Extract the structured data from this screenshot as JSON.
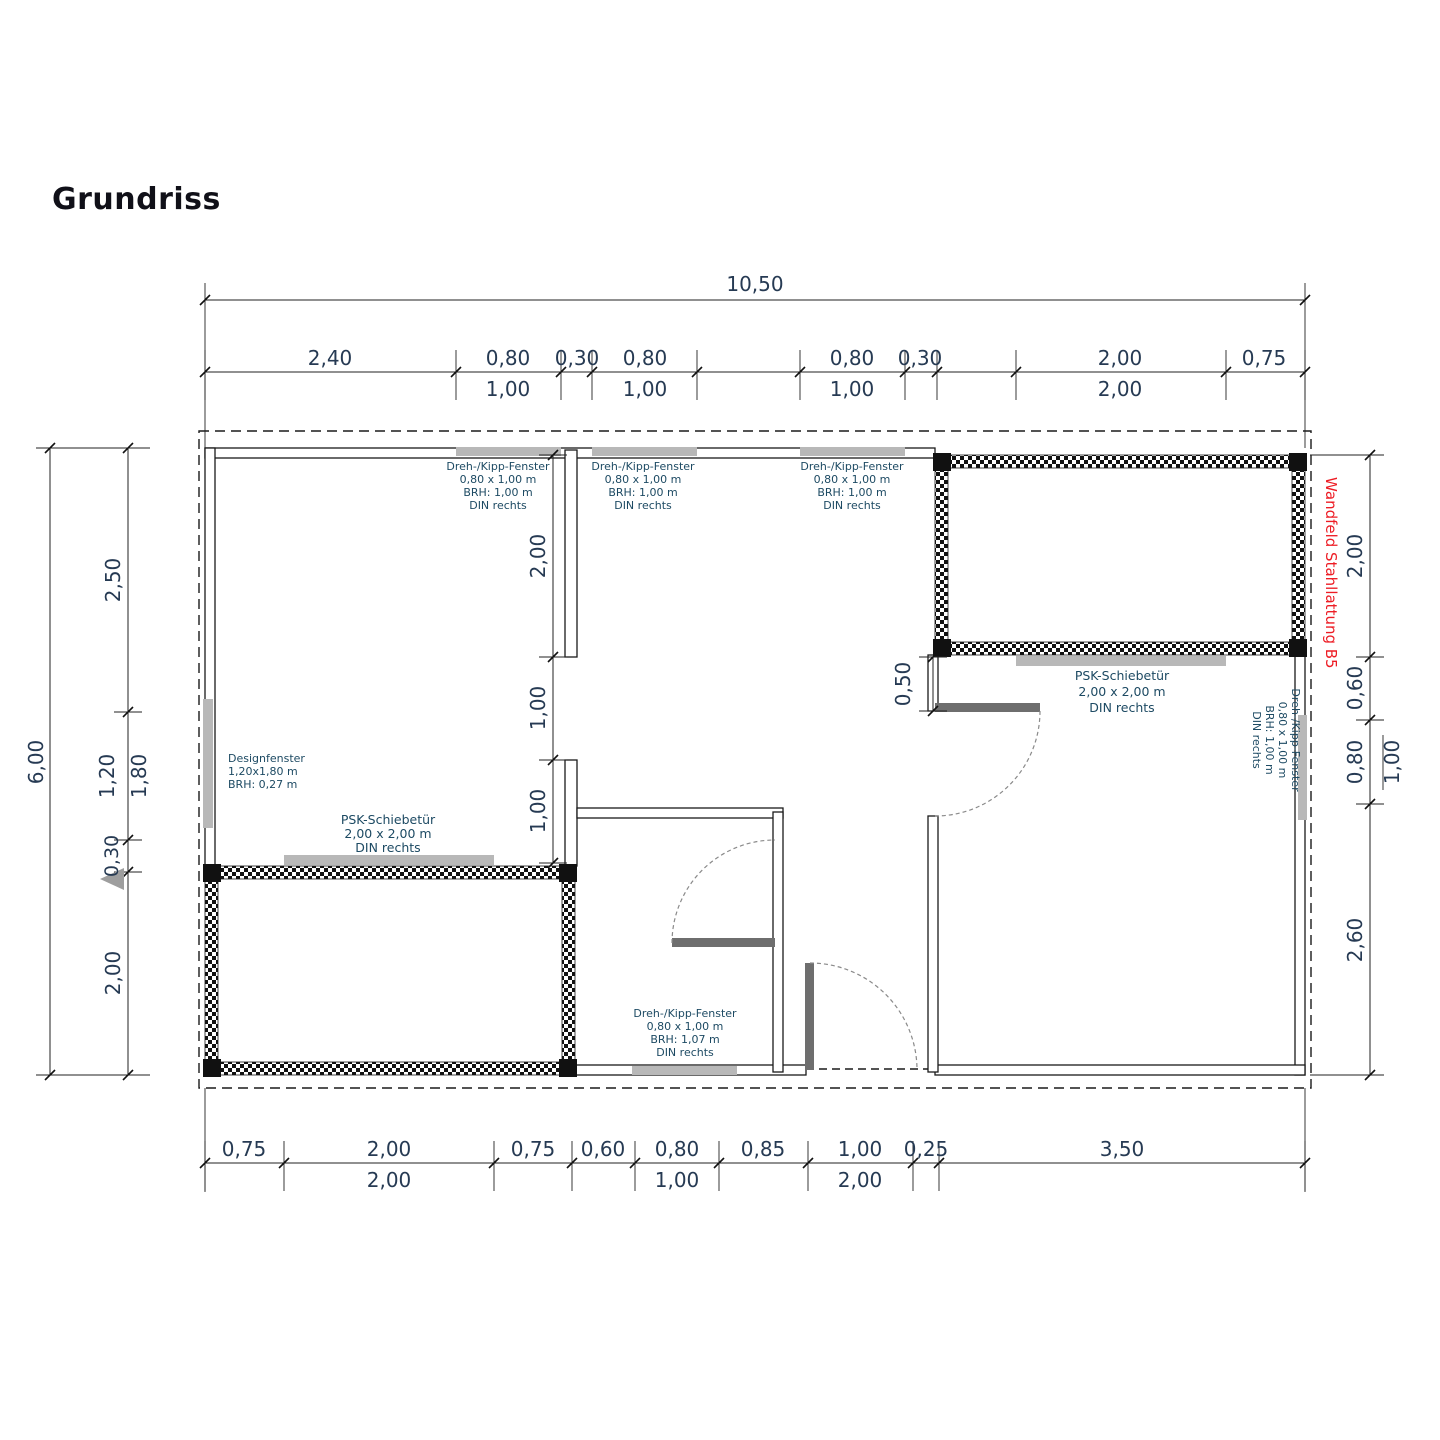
{
  "title": "Grundriss",
  "colors": {
    "red_note": "#ed1c24",
    "window_strip": "#b8b8b8",
    "door_leaf": "#6e6e6e",
    "dimension_text": "#263a53",
    "label_text": "#1d4a63"
  },
  "dims": {
    "top_overall": "10,50",
    "top_primary": [
      "2,40",
      "0,80",
      "0,30",
      "0,80",
      "0,80",
      "0,30",
      "2,00",
      "0,75"
    ],
    "top_secondary": [
      "1,00",
      "1,00",
      "1,00",
      "2,00"
    ],
    "bottom_primary": [
      "0,75",
      "2,00",
      "0,75",
      "0,60",
      "0,80",
      "0,85",
      "1,00",
      "0,25",
      "3,50"
    ],
    "bottom_secondary": [
      "2,00",
      "1,00",
      "2,00"
    ],
    "left_overall": "6,00",
    "left_chain": [
      "2,50",
      "1,20",
      "1,80",
      "0,30",
      "2,00"
    ],
    "right_chain": [
      "2,00",
      "0,60",
      "0,80",
      "1,00",
      "2,60"
    ],
    "interior_left_chain": [
      "2,00",
      "1,00",
      "1,00"
    ],
    "interior_door_offset": "0,50"
  },
  "labels": {
    "win_top1": [
      "Dreh-/Kipp-Fenster",
      "0,80 x 1,00 m",
      "BRH: 1,00 m",
      "DIN rechts"
    ],
    "win_top2": [
      "Dreh-/Kipp-Fenster",
      "0,80 x 1,00 m",
      "BRH: 1,00 m",
      "DIN rechts"
    ],
    "win_top3": [
      "Dreh-/Kipp-Fenster",
      "0,80 x 1,00 m",
      "BRH: 1,00 m",
      "DIN rechts"
    ],
    "win_bottom": [
      "Dreh-/Kipp-Fenster",
      "0,80 x 1,00 m",
      "BRH: 1,07 m",
      "DIN rechts"
    ],
    "win_right": [
      "Dreh-/Kipp-Fenster",
      "0,80 x 1,00 m",
      "BRH: 1,00 m",
      "DIN rechts"
    ],
    "design_window": [
      "Designfenster",
      "1,20x1,80 m",
      "BRH: 0,27 m"
    ],
    "psk_left": [
      "PSK-Schiebetür",
      "2,00 x 2,00 m",
      "DIN rechts"
    ],
    "psk_right": [
      "PSK-Schiebetür",
      "2,00 x 2,00 m",
      "DIN rechts"
    ],
    "red_note": "Wandfeld Stahllattung B5"
  }
}
